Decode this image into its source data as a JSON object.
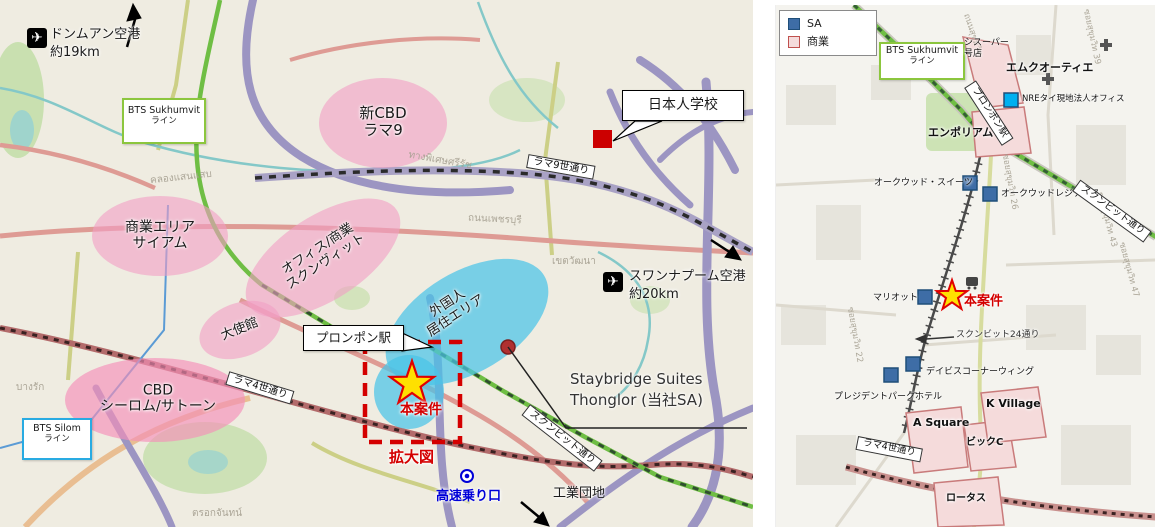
{
  "left_map": {
    "airports": {
      "don_mueang": {
        "name": "ドンムアン空港",
        "distance": "約19km"
      },
      "suvarnabhumi": {
        "name": "スワンナプーム空港",
        "distance": "約20km"
      }
    },
    "transit": {
      "bts_sukhumvit": {
        "line1": "BTS Sukhumvit",
        "line2": "ライン"
      },
      "bts_silom": {
        "line1": "BTS Silom",
        "line2": "ライン"
      }
    },
    "areas": {
      "new_cbd": {
        "line1": "新CBD",
        "line2": "ラマ9"
      },
      "siam": {
        "line1": "商業エリア",
        "line2": "サイアム"
      },
      "office_sukhumvit": {
        "line1": "オフィス/商業",
        "line2": "スクンヴィット"
      },
      "embassy": {
        "label": "大使館"
      },
      "cbd_silom": {
        "line1": "CBD",
        "line2": "シーロム/サトーン"
      },
      "foreign_residential": {
        "line1": "外国人",
        "line2": "居住エリア"
      }
    },
    "roads": {
      "rama9": "ラマ9世通り",
      "rama4": "ラマ4世通り",
      "sukhumvit": "スクンビット通り"
    },
    "pois": {
      "japanese_school": "日本人学校",
      "phrom_phong_station": "プロンポン駅",
      "staybridge_line1": "Staybridge Suites",
      "staybridge_line2": "Thonglor (当社SA)",
      "expressway_entrance": "高速乗り口",
      "industrial_park": "工業団地"
    },
    "project": {
      "label": "本案件",
      "enlarged_view": "拡大図"
    },
    "background_labels": [
      {
        "text": "คลองแสนแสบ"
      },
      {
        "text": "ทางพิเศษศรีรัช"
      },
      {
        "text": "ถนนเพชรบุรี"
      },
      {
        "text": "เขตวัฒนา"
      },
      {
        "text": "บางรัก"
      },
      {
        "text": "ตรอกจันทน์"
      }
    ]
  },
  "right_map": {
    "legend": {
      "sa": "SA",
      "commercial": "商業"
    },
    "transit": {
      "bts_sukhumvit": {
        "line1": "BTS Sukhumvit",
        "line2": "ライン"
      }
    },
    "roads": {
      "phrom_phong_station": "プロンポン駅",
      "sukhumvit": "スクンビット通り",
      "soi24": "スクンビット24通り",
      "rama4": "ラマ4世通り"
    },
    "pois": {
      "super_line1": "シスーパー",
      "super_line2": "号店",
      "emquartier": "エムクオーティエ",
      "nre_office": "NREタイ現地法人オフィス",
      "emporium": "エンポリアム",
      "oakwood_suites": "オークウッド・スイーツ",
      "oakwood_residence": "オークウッドレジデンス",
      "marriott": "マリオット",
      "davis_corner_wing": "デイビスコーナーウィング",
      "president_park_hotel": "プレジデントパークホテル",
      "k_village": "K Village",
      "a_square": "A Square",
      "big_c": "ビックC",
      "lotus": "ロータス"
    },
    "project": {
      "label": "本案件"
    },
    "background_labels": [
      {
        "text": "ซอยสุขุมวิท 39"
      },
      {
        "text": "ถนนสุขุมวิท"
      },
      {
        "text": "ซอยสุขุมวิท 26"
      },
      {
        "text": "ซอยสุขุมวิท 22"
      },
      {
        "text": "ซอยสุขุมวิท 43"
      },
      {
        "text": "ซอยสุขุมวิท 47"
      }
    ]
  },
  "colors": {
    "project_red": "#D40000",
    "star_yellow": "#FFE000",
    "sa_blue": "#3E6DA6",
    "nre_blue": "#00B0F0",
    "commercial_pink_fill": "#F5DBDB",
    "area_pink": "#F29FC5",
    "residential_blue": "#49C3E8",
    "bts_sukhumvit_green": "#6FBE44",
    "bts_silom_blue": "#29ABE2",
    "school_marker_red": "#CC0000"
  }
}
